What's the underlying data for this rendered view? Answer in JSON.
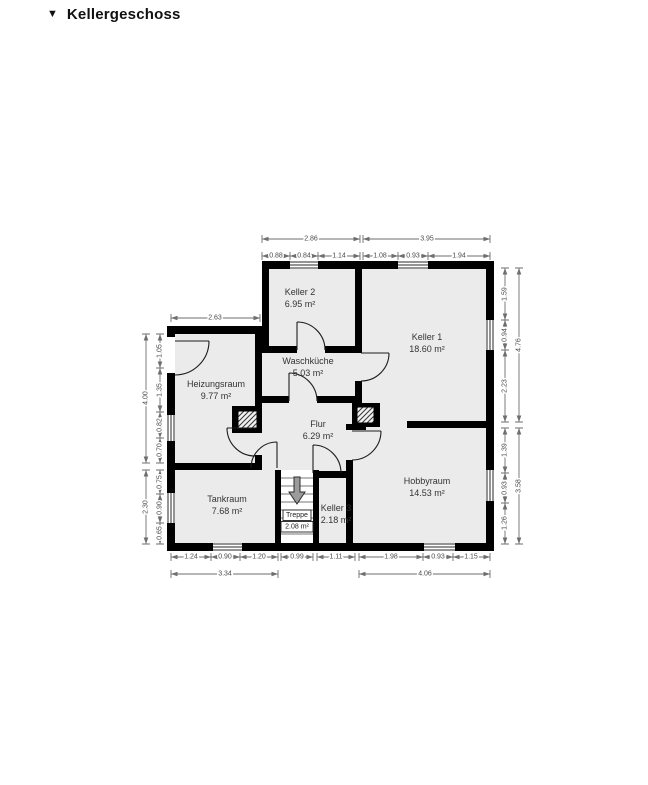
{
  "header": {
    "collapse_icon": "▼",
    "title": "Kellergeschoss"
  },
  "rooms": {
    "keller2": {
      "name": "Keller 2",
      "area": "6.95 m²"
    },
    "keller1": {
      "name": "Keller 1",
      "area": "18.60 m²"
    },
    "waschkueche": {
      "name": "Waschküche",
      "area": "5.03 m²"
    },
    "heizungsraum": {
      "name": "Heizungsraum",
      "area": "9.77 m²"
    },
    "flur": {
      "name": "Flur",
      "area": "6.29 m²"
    },
    "tankraum": {
      "name": "Tankraum",
      "area": "7.68 m²"
    },
    "treppe": {
      "name": "Treppe",
      "area": "2.08 m²"
    },
    "keller3": {
      "name": "Keller 3",
      "area": "2.18 m²"
    },
    "hobbyraum": {
      "name": "Hobbyraum",
      "area": "14.53 m²"
    }
  },
  "dimensions": {
    "top_left": {
      "total": "2.86",
      "segments": [
        "0.88",
        "0.84",
        "1.14"
      ]
    },
    "top_right": {
      "total": "3.95",
      "segments": [
        "1.08",
        "0.93",
        "1.94"
      ]
    },
    "heizungsraum_width": "2.63",
    "left_upper": {
      "total": "4.00",
      "segments": [
        "1.05",
        "1.35",
        "0.82",
        "0.70"
      ]
    },
    "left_lower": {
      "total": "2.30",
      "segments": [
        "0.75",
        "0.90",
        "0.65"
      ]
    },
    "right_upper": {
      "total": "4.76",
      "segments": [
        "1.59",
        "0.94",
        "2.23"
      ]
    },
    "right_lower": {
      "total": "3.58",
      "segments": [
        "1.39",
        "0.93",
        "1.26"
      ]
    },
    "bottom_left": {
      "total": "3.34",
      "segments": [
        "1.24",
        "0.90",
        "1.20"
      ]
    },
    "bottom_stairs": "0.99",
    "bottom_keller3": "1.11",
    "bottom_right": {
      "total": "4.06",
      "segments": [
        "1.98",
        "0.93",
        "1.15"
      ]
    }
  },
  "colors": {
    "wall": "#000000",
    "room_fill": "#ebebeb",
    "dimension_text": "#4a4a4a",
    "stairs_arrow": "#9b9b9b"
  }
}
